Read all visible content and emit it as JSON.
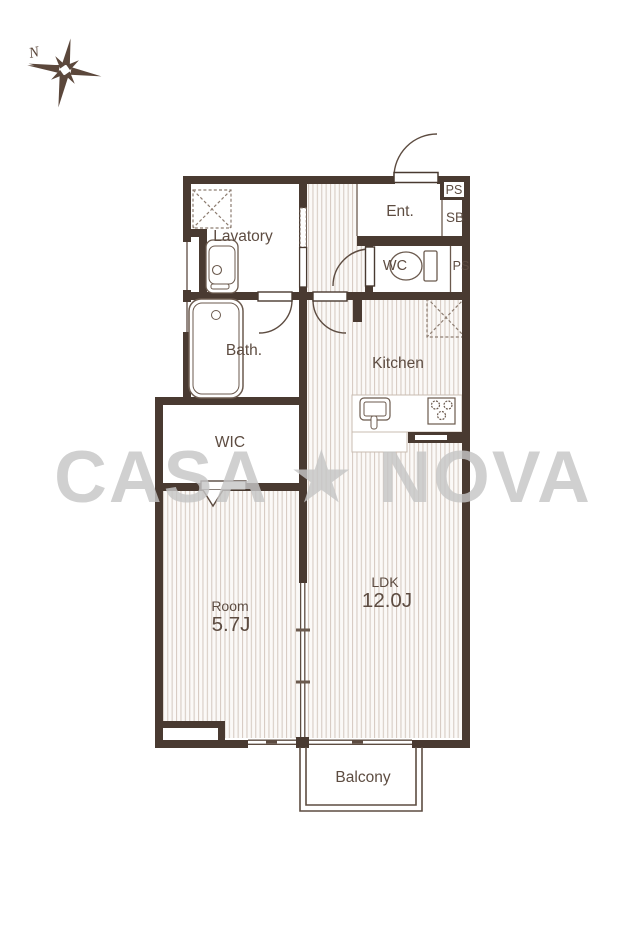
{
  "watermark": {
    "text": "CASA ★ NOVA"
  },
  "compass": {
    "label": "N"
  },
  "rooms": {
    "lavatory": {
      "label": "Lavatory"
    },
    "entrance": {
      "label": "Ent."
    },
    "pipe_space_top": {
      "label": "PS"
    },
    "shoe_box": {
      "label": "SB"
    },
    "wc": {
      "label": "WC"
    },
    "pipe_space_right": {
      "label": "PS"
    },
    "bath": {
      "label": "Bath."
    },
    "kitchen": {
      "label": "Kitchen"
    },
    "wic": {
      "label": "WIC"
    },
    "bedroom": {
      "label": "Room",
      "size": "5.7J"
    },
    "ldk": {
      "label": "LDK",
      "size": "12.0J"
    },
    "balcony": {
      "label": "Balcony"
    }
  },
  "fixtures": {
    "washer_pan": "washing-machine-pan",
    "vanity": "vanity-sink",
    "bathtub": "bathtub",
    "toilet": "toilet",
    "kitchen_sink": "kitchen-sink",
    "stove": "stove-burners",
    "fridge_space": "refrigerator-space"
  },
  "colors": {
    "wall": "#493a31",
    "line": "#5d4c41",
    "stripe": "#d7ccc4",
    "floor": "#fbf9f7",
    "watermark": "#c6c6c6",
    "label": "#5d4c41"
  }
}
